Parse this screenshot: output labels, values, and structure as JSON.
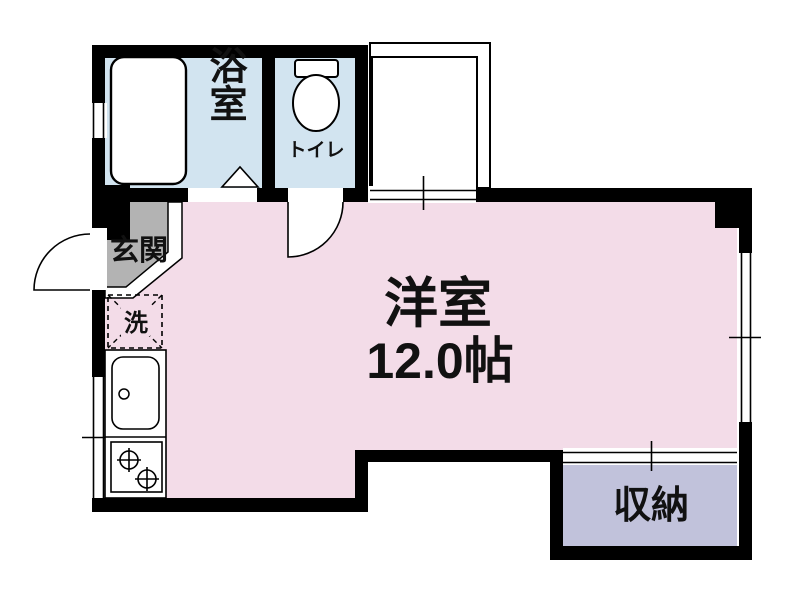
{
  "floorplan": {
    "title": "apartment-floor-plan",
    "rooms": {
      "main": {
        "name_label": "洋室",
        "size_label": "12.0帖",
        "color": "#f3dce8"
      },
      "bathroom": {
        "label": "浴室",
        "color": "#d2e4f0"
      },
      "toilet": {
        "label": "トイレ",
        "color": "#d2e4f0"
      },
      "entrance": {
        "label": "玄関",
        "color": "#b3b3b3"
      },
      "laundry": {
        "label": "洗"
      },
      "storage": {
        "label": "収納",
        "color": "#c1c2db"
      }
    },
    "colors": {
      "wall": "#000000",
      "line": "#000000",
      "background": "#ffffff",
      "fixture_fill": "#ffffff"
    }
  }
}
